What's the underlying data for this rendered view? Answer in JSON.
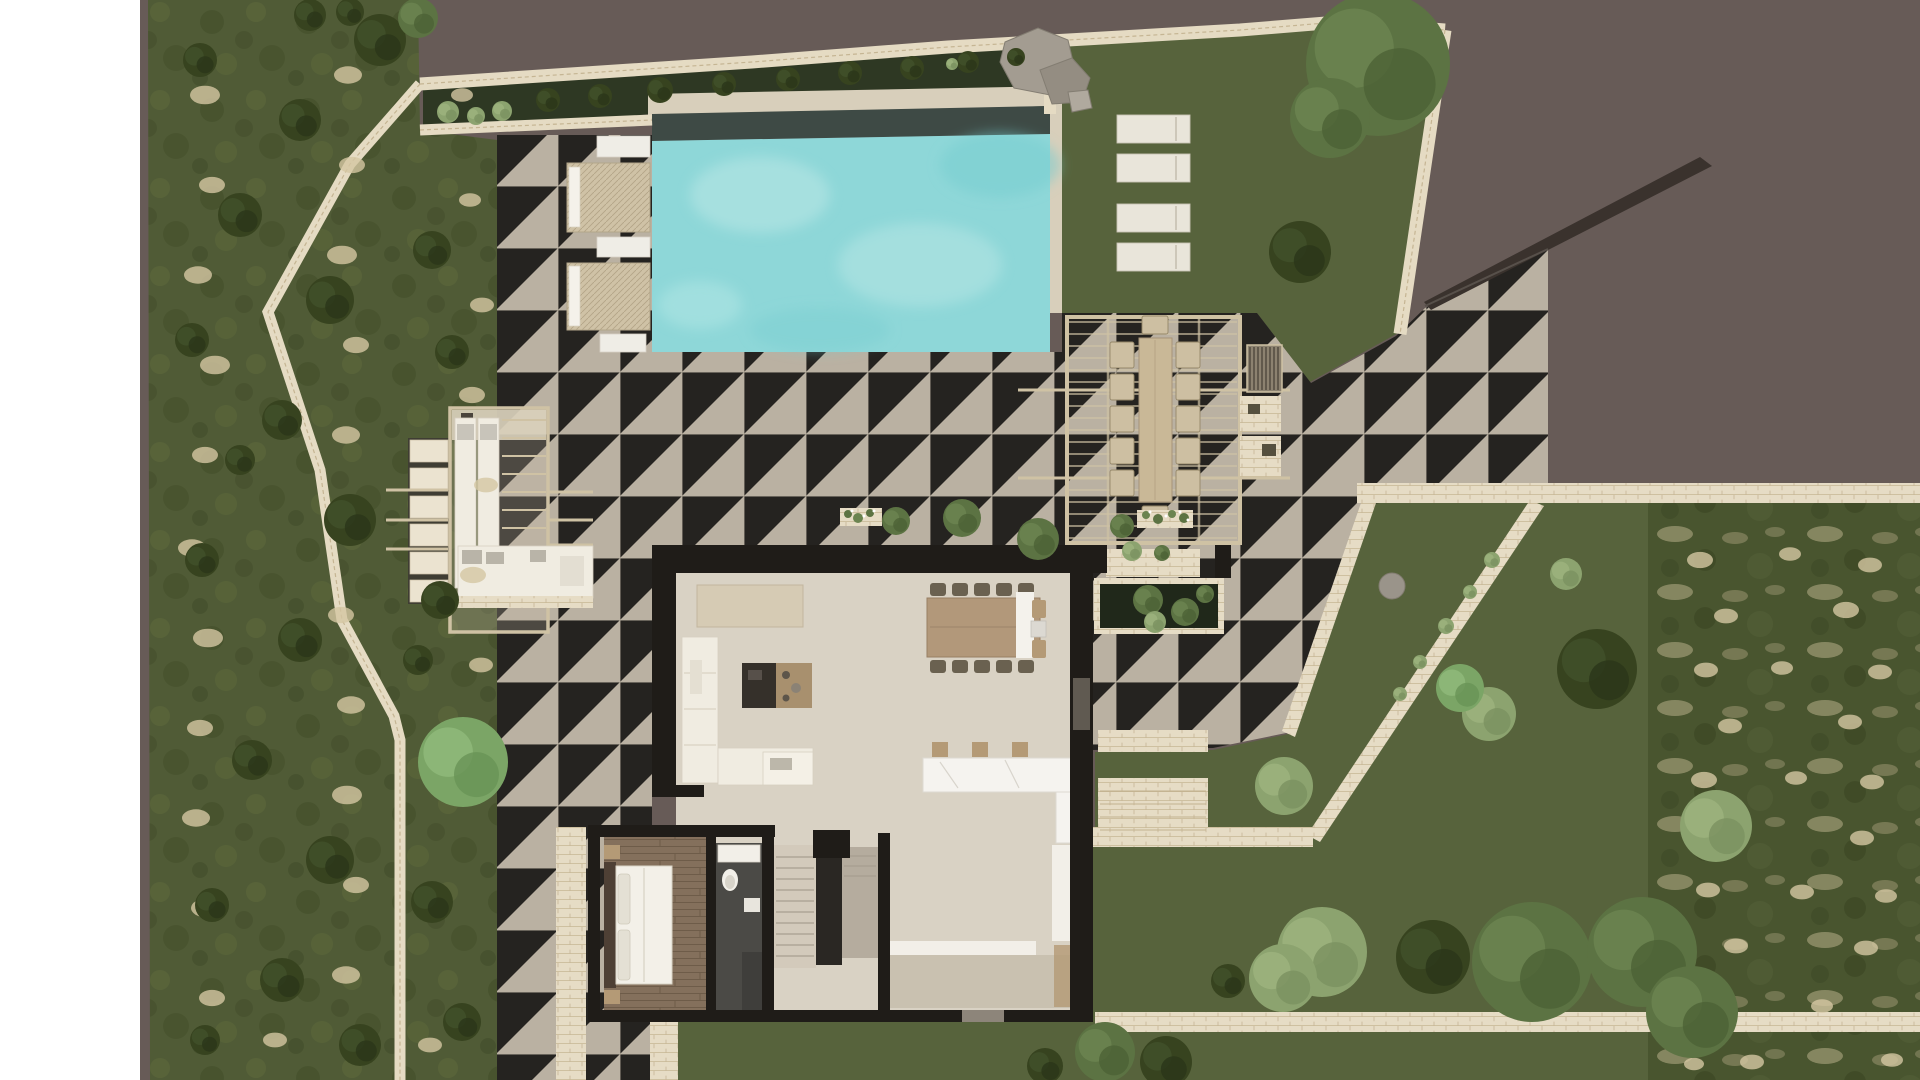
{
  "scene": {
    "type": "architectural-site-plan",
    "view": "top-down-render",
    "visible_text": "",
    "features": [
      "swimming-pool",
      "main-villa-floorplan",
      "pool-terrace",
      "outdoor-dining-pergola",
      "west-lounge-pergola",
      "olive-grove-west",
      "olive-grove-southeast",
      "lawn-northeast",
      "lawn-southeast",
      "stone-boundary-walls",
      "driveway-cut"
    ]
  },
  "palette": {
    "paper": "#ffffff",
    "taupe": "#675b57",
    "wedge": "#3a322d",
    "lawn": "#57633c",
    "hedge": "#2e3823",
    "grove": "#505b36",
    "sand": "#d4c7a2",
    "stone": "#e5dbc3",
    "stoneline": "#bfae8b",
    "terrace": "#bab1a2",
    "coping": "#d8cfbb",
    "gutter": "#3e4a45",
    "pool": "#8ed7d8",
    "poollight": "#b9e8e6",
    "pooldark": "#79cdcf",
    "housewall": "#1f1c18",
    "floor": "#d9d2c4",
    "floor2": "#c9c1b0",
    "bathfloor": "#4b4a46",
    "sofa": "#f0ece1",
    "lounger": "#e9e5da",
    "tanwood": "#b49a76",
    "chair": "#6a6150",
    "pergola": "#cfc2a4",
    "island": "#f5f3ef"
  },
  "counts": {
    "pool_daybeds": 2,
    "pool_sun_mats": 3,
    "lawn_loungers": 4,
    "indoor_dining_chairs": 10,
    "outdoor_dining_seats": 12,
    "kitchen_bar_stools": 3,
    "west_deck_loungers": 2,
    "planters": 4
  },
  "rooms": [
    "living-room",
    "dining-area",
    "kitchen",
    "hallway-entry",
    "stairs",
    "bathroom",
    "bedroom"
  ],
  "vegetation": {
    "trees": [
      [
        380,
        40,
        26,
        "dark"
      ],
      [
        300,
        120,
        21,
        "dark"
      ],
      [
        240,
        215,
        22,
        "dark"
      ],
      [
        330,
        300,
        24,
        "dark"
      ],
      [
        282,
        420,
        20,
        "dark"
      ],
      [
        350,
        520,
        26,
        "dark"
      ],
      [
        300,
        640,
        22,
        "dark"
      ],
      [
        252,
        760,
        20,
        "dark"
      ],
      [
        330,
        860,
        24,
        "dark"
      ],
      [
        282,
        980,
        22,
        "dark"
      ],
      [
        360,
        1045,
        21,
        "dark"
      ],
      [
        200,
        60,
        17,
        "dark"
      ],
      [
        192,
        340,
        17,
        "dark"
      ],
      [
        202,
        560,
        17,
        "dark"
      ],
      [
        212,
        905,
        17,
        "dark"
      ],
      [
        432,
        250,
        19,
        "dark"
      ],
      [
        452,
        352,
        17,
        "dark"
      ],
      [
        440,
        600,
        19,
        "dark"
      ],
      [
        432,
        902,
        21,
        "dark"
      ],
      [
        462,
        1022,
        19,
        "dark"
      ],
      [
        418,
        18,
        20,
        "mid"
      ],
      [
        310,
        15,
        16,
        "dark"
      ],
      [
        350,
        12,
        14,
        "dark"
      ],
      [
        240,
        460,
        15,
        "dark"
      ],
      [
        418,
        660,
        15,
        "dark"
      ],
      [
        205,
        1040,
        15,
        "dark"
      ],
      [
        463,
        762,
        45,
        "light"
      ],
      [
        448,
        112,
        11,
        "sage"
      ],
      [
        476,
        116,
        9,
        "sage"
      ],
      [
        502,
        111,
        10,
        "sage"
      ],
      [
        548,
        100,
        12,
        "dark"
      ],
      [
        600,
        96,
        12,
        "dark"
      ],
      [
        660,
        90,
        13,
        "dark"
      ],
      [
        724,
        84,
        12,
        "dark"
      ],
      [
        788,
        79,
        12,
        "dark"
      ],
      [
        850,
        73,
        12,
        "dark"
      ],
      [
        912,
        68,
        12,
        "dark"
      ],
      [
        968,
        62,
        11,
        "dark"
      ],
      [
        1016,
        57,
        9,
        "dark"
      ],
      [
        952,
        64,
        6,
        "sage"
      ],
      [
        1378,
        64,
        72,
        "mid"
      ],
      [
        1330,
        118,
        40,
        "mid"
      ],
      [
        1300,
        252,
        31,
        "dark"
      ],
      [
        1148,
        600,
        15,
        "mid"
      ],
      [
        1185,
        612,
        14,
        "mid"
      ],
      [
        1155,
        622,
        11,
        "sage"
      ],
      [
        1205,
        594,
        9,
        "mid"
      ],
      [
        1132,
        551,
        10,
        "sage"
      ],
      [
        1162,
        553,
        8,
        "mid"
      ],
      [
        896,
        521,
        14,
        "mid"
      ],
      [
        962,
        518,
        19,
        "mid"
      ],
      [
        1038,
        539,
        21,
        "mid"
      ],
      [
        1122,
        526,
        12,
        "mid"
      ],
      [
        1597,
        669,
        40,
        "dark"
      ],
      [
        1489,
        714,
        27,
        "sage"
      ],
      [
        1284,
        786,
        29,
        "sage"
      ],
      [
        1322,
        952,
        45,
        "sage"
      ],
      [
        1283,
        978,
        34,
        "sage"
      ],
      [
        1433,
        957,
        37,
        "dark"
      ],
      [
        1228,
        981,
        17,
        "dark"
      ],
      [
        1532,
        962,
        60,
        "mid"
      ],
      [
        1642,
        952,
        55,
        "mid"
      ],
      [
        1692,
        1012,
        46,
        "mid"
      ],
      [
        1716,
        826,
        36,
        "sage"
      ],
      [
        1460,
        688,
        24,
        "light"
      ],
      [
        1566,
        574,
        16,
        "sage"
      ],
      [
        1492,
        560,
        8,
        "sage"
      ],
      [
        1470,
        592,
        7,
        "sage"
      ],
      [
        1446,
        626,
        8,
        "sage"
      ],
      [
        1420,
        662,
        7,
        "sage"
      ],
      [
        1400,
        694,
        7,
        "sage"
      ],
      [
        1105,
        1052,
        30,
        "mid"
      ],
      [
        1166,
        1062,
        26,
        "dark"
      ],
      [
        1045,
        1066,
        18,
        "dark"
      ]
    ],
    "sand_patches": [
      [
        205,
        95,
        15
      ],
      [
        212,
        185,
        13
      ],
      [
        198,
        275,
        14
      ],
      [
        215,
        365,
        15
      ],
      [
        205,
        455,
        13
      ],
      [
        192,
        548,
        14
      ],
      [
        208,
        638,
        15
      ],
      [
        200,
        728,
        13
      ],
      [
        196,
        818,
        14
      ],
      [
        206,
        908,
        15
      ],
      [
        212,
        998,
        13
      ],
      [
        348,
        75,
        14
      ],
      [
        352,
        165,
        13
      ],
      [
        342,
        255,
        15
      ],
      [
        356,
        345,
        13
      ],
      [
        346,
        435,
        14
      ],
      [
        352,
        525,
        15
      ],
      [
        341,
        615,
        13
      ],
      [
        351,
        705,
        14
      ],
      [
        347,
        795,
        15
      ],
      [
        356,
        885,
        13
      ],
      [
        346,
        975,
        14
      ],
      [
        482,
        305,
        12
      ],
      [
        472,
        395,
        13
      ],
      [
        486,
        485,
        12
      ],
      [
        473,
        575,
        13
      ],
      [
        481,
        665,
        12
      ],
      [
        476,
        755,
        12
      ],
      [
        470,
        200,
        11
      ],
      [
        462,
        95,
        11
      ],
      [
        275,
        1040,
        12
      ],
      [
        430,
        1045,
        12
      ],
      [
        1700,
        560,
        13
      ],
      [
        1790,
        554,
        11
      ],
      [
        1870,
        565,
        12
      ],
      [
        1726,
        616,
        12
      ],
      [
        1846,
        610,
        13
      ],
      [
        1706,
        670,
        12
      ],
      [
        1782,
        668,
        11
      ],
      [
        1880,
        672,
        12
      ],
      [
        1730,
        726,
        12
      ],
      [
        1850,
        722,
        12
      ],
      [
        1704,
        780,
        13
      ],
      [
        1796,
        778,
        11
      ],
      [
        1872,
        782,
        12
      ],
      [
        1720,
        836,
        12
      ],
      [
        1862,
        838,
        12
      ],
      [
        1708,
        890,
        12
      ],
      [
        1802,
        892,
        12
      ],
      [
        1886,
        896,
        11
      ],
      [
        1736,
        946,
        12
      ],
      [
        1866,
        948,
        12
      ],
      [
        1712,
        1000,
        12
      ],
      [
        1822,
        1006,
        11
      ],
      [
        1892,
        1060,
        11
      ],
      [
        1752,
        1062,
        12
      ],
      [
        1694,
        1064,
        10
      ]
    ]
  }
}
